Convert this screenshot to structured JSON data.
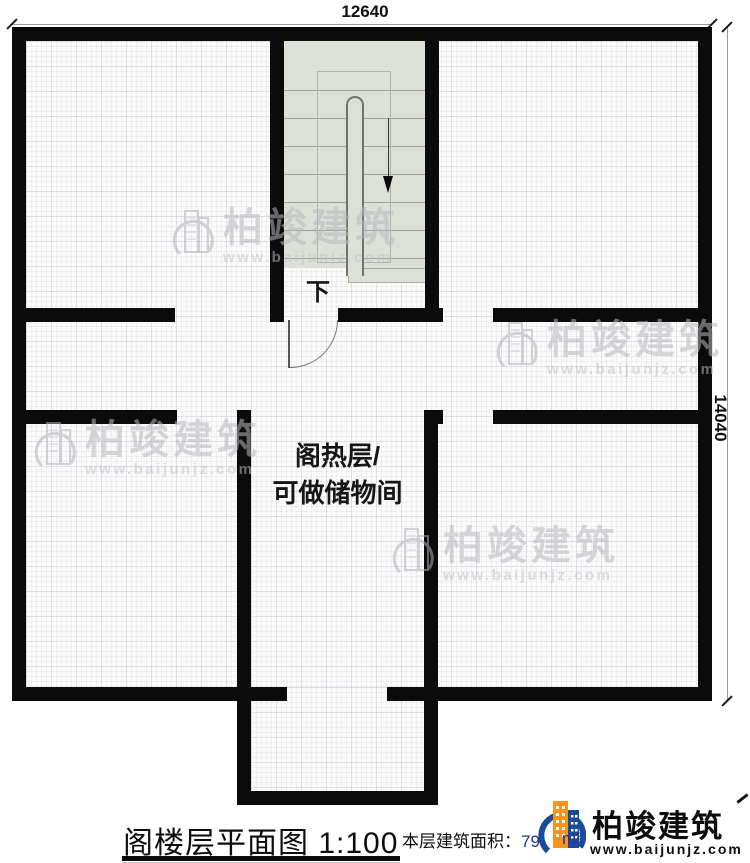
{
  "plan": {
    "dim_top": "12640",
    "dim_right": "14040",
    "stair_label": "下",
    "room_label_line1": "阁热层/",
    "room_label_line2": "可做储物间"
  },
  "footer": {
    "title": "阁楼层平面图",
    "scale": "1:100",
    "area_label": "本层建筑面积：",
    "area_value": "79",
    "area_unit": "m²"
  },
  "brand": {
    "name": "柏竣建筑",
    "url": "www.baijunjz.com"
  },
  "watermark": {
    "name": "柏竣建筑",
    "url": "www.baijunjz.com"
  },
  "colors": {
    "wall": "#0b0b0b",
    "stair_bg": "#dce1d8",
    "brand_blue": "#1b4a9b",
    "brand_orange": "#f7941d",
    "watermark_gray": "#bcbcc1"
  }
}
